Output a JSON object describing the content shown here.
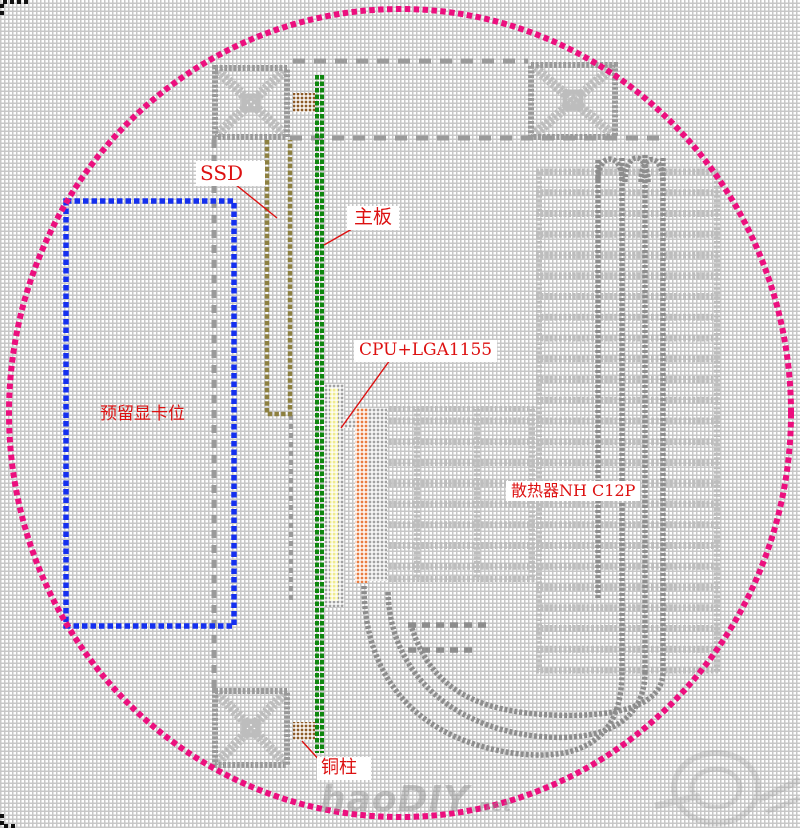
{
  "labels": {
    "ssd": "SSD",
    "motherboard": "主板",
    "gpu_slot": "预留显卡位",
    "cpu": "CPU+LGA1155",
    "cooler": "散热器NH C12P",
    "copper_pillar": "铜柱"
  },
  "watermark": {
    "main": "haoDIY",
    "suffix": ".net"
  },
  "colors": {
    "mesh_gray": "#c7c7c7",
    "circle_pink": "#ec0f7e",
    "gpu_blue": "#1530ef",
    "board_green": "#0e870e",
    "ssd_olive": "#8d8040",
    "cpu_yellow": "#f0ec8c",
    "cooler_orange": "#e97c41",
    "copper_brown": "#8d5a26",
    "label_red": "#dd1111",
    "draw_gray": "#9a9a9a",
    "draw_light": "#bdbdbd",
    "pipe_gray": "#8d8d8d",
    "socket_gray": "#a2a2a2",
    "corner_black": "#111111"
  }
}
